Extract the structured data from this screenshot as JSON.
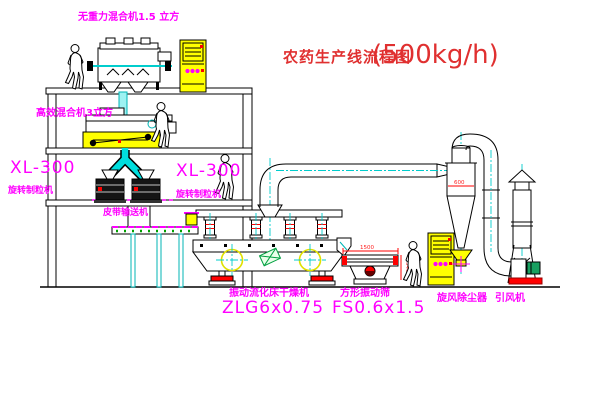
{
  "title": {
    "cn": "农药生产线流程图",
    "capacity": "(500kg/h)"
  },
  "labels": {
    "mixer_top": "无重力混合机1.5 立方",
    "mixer_mid": "高效混合机3立方",
    "granulator_left_model": "XL-300",
    "granulator_left_name": "旋转制粒机",
    "granulator_right_model": "XL-300",
    "granulator_right_name": "旋转制粒机",
    "belt_conveyor": "皮带输送机",
    "dryer_name": "振动流化床干燥机",
    "dryer_model": "ZLG6x0.75",
    "screen_name": "方形振动筛",
    "screen_model": "FS0.6x1.5",
    "cyclone_name": "旋风除尘器",
    "fan_name": "引风机"
  },
  "dimensions": {
    "cyclone_width": "600",
    "screen_length": "1500",
    "screen_height": "540"
  },
  "colors": {
    "label_magenta": "#ff00ff",
    "title_red": "#e03030",
    "line_black": "#000000",
    "pipe_cyan": "#00cdcd",
    "machine_yellow": "#ffff00",
    "dimension_red": "#ff2020",
    "detail_green": "#00a040"
  },
  "icons": {
    "cabinet_indicator": "magenta-dots",
    "crosshair": "vibration-motor-mark"
  }
}
